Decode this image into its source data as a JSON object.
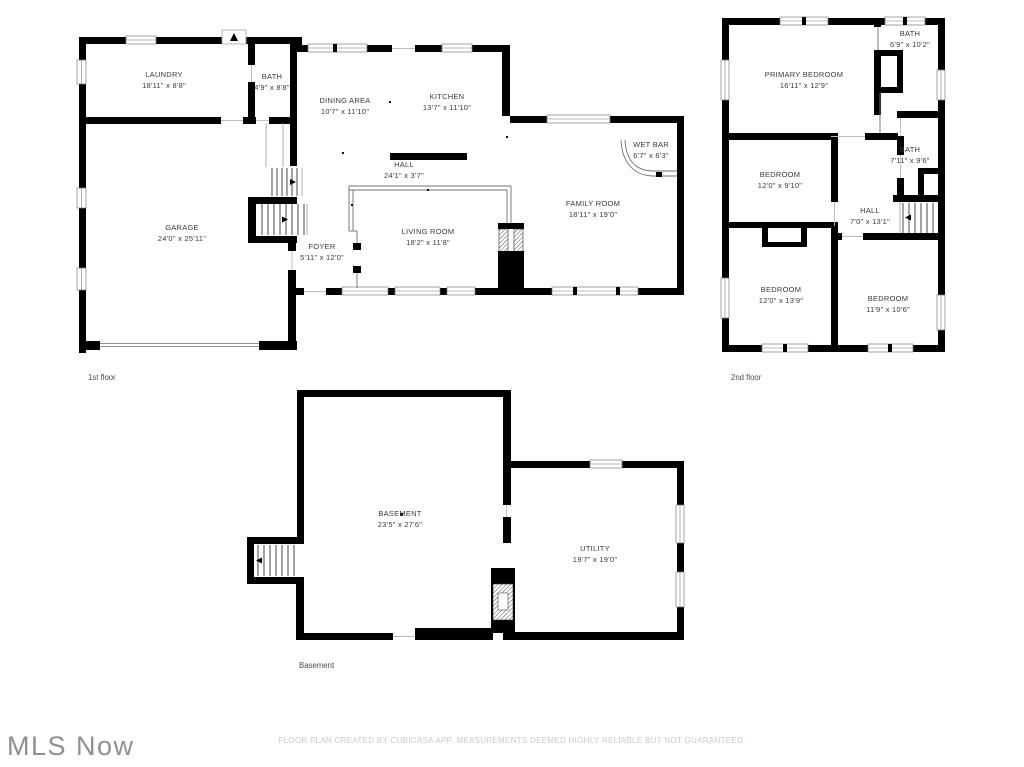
{
  "colors": {
    "wall": "#000000",
    "room_text": "#3a3a3a",
    "footer_text": "#c7c9cb",
    "logo_text": "#8f9092"
  },
  "floors": {
    "first": {
      "caption": "1st floor",
      "rooms": [
        {
          "name": "LAUNDRY",
          "dims": "18'11\" x 8'8\""
        },
        {
          "name": "BATH",
          "dims": "4'9\" x 8'8\""
        },
        {
          "name": "DINING AREA",
          "dims": "10'7\" x 11'10\""
        },
        {
          "name": "KITCHEN",
          "dims": "13'7\" x 11'10\""
        },
        {
          "name": "WET BAR",
          "dims": "6'7\" x 6'3\""
        },
        {
          "name": "HALL",
          "dims": "24'1\" x 3'7\""
        },
        {
          "name": "GARAGE",
          "dims": "24'0\" x 25'11\""
        },
        {
          "name": "FOYER",
          "dims": "5'11\" x 12'0\""
        },
        {
          "name": "LIVING ROOM",
          "dims": "18'2\" x 11'8\""
        },
        {
          "name": "FAMILY ROOM",
          "dims": "18'11\" x 19'0\""
        }
      ]
    },
    "second": {
      "caption": "2nd floor",
      "rooms": [
        {
          "name": "BATH",
          "dims": "6'9\" x 10'2\""
        },
        {
          "name": "PRIMARY BEDROOM",
          "dims": "16'11\" x 12'9\""
        },
        {
          "name": "BEDROOM",
          "dims": "12'0\" x 9'10\""
        },
        {
          "name": "BATH",
          "dims": "7'11\" x 9'6\""
        },
        {
          "name": "HALL",
          "dims": "7'0\" x 13'1\""
        },
        {
          "name": "BEDROOM",
          "dims": "12'0\" x 13'9\""
        },
        {
          "name": "BEDROOM",
          "dims": "11'9\" x 10'6\""
        }
      ]
    },
    "basement": {
      "caption": "Basement",
      "rooms": [
        {
          "name": "BASEMENT",
          "dims": "23'5\" x 27'6\""
        },
        {
          "name": "UTILITY",
          "dims": "19'7\" x 19'0\""
        }
      ]
    }
  },
  "footer": {
    "disclaimer": "FLOOR PLAN CREATED BY CUBICASA APP. MEASUREMENTS DEEMED HIGHLY RELIABLE BUT NOT GUARANTEED."
  },
  "branding": {
    "logo": "MLS Now"
  }
}
